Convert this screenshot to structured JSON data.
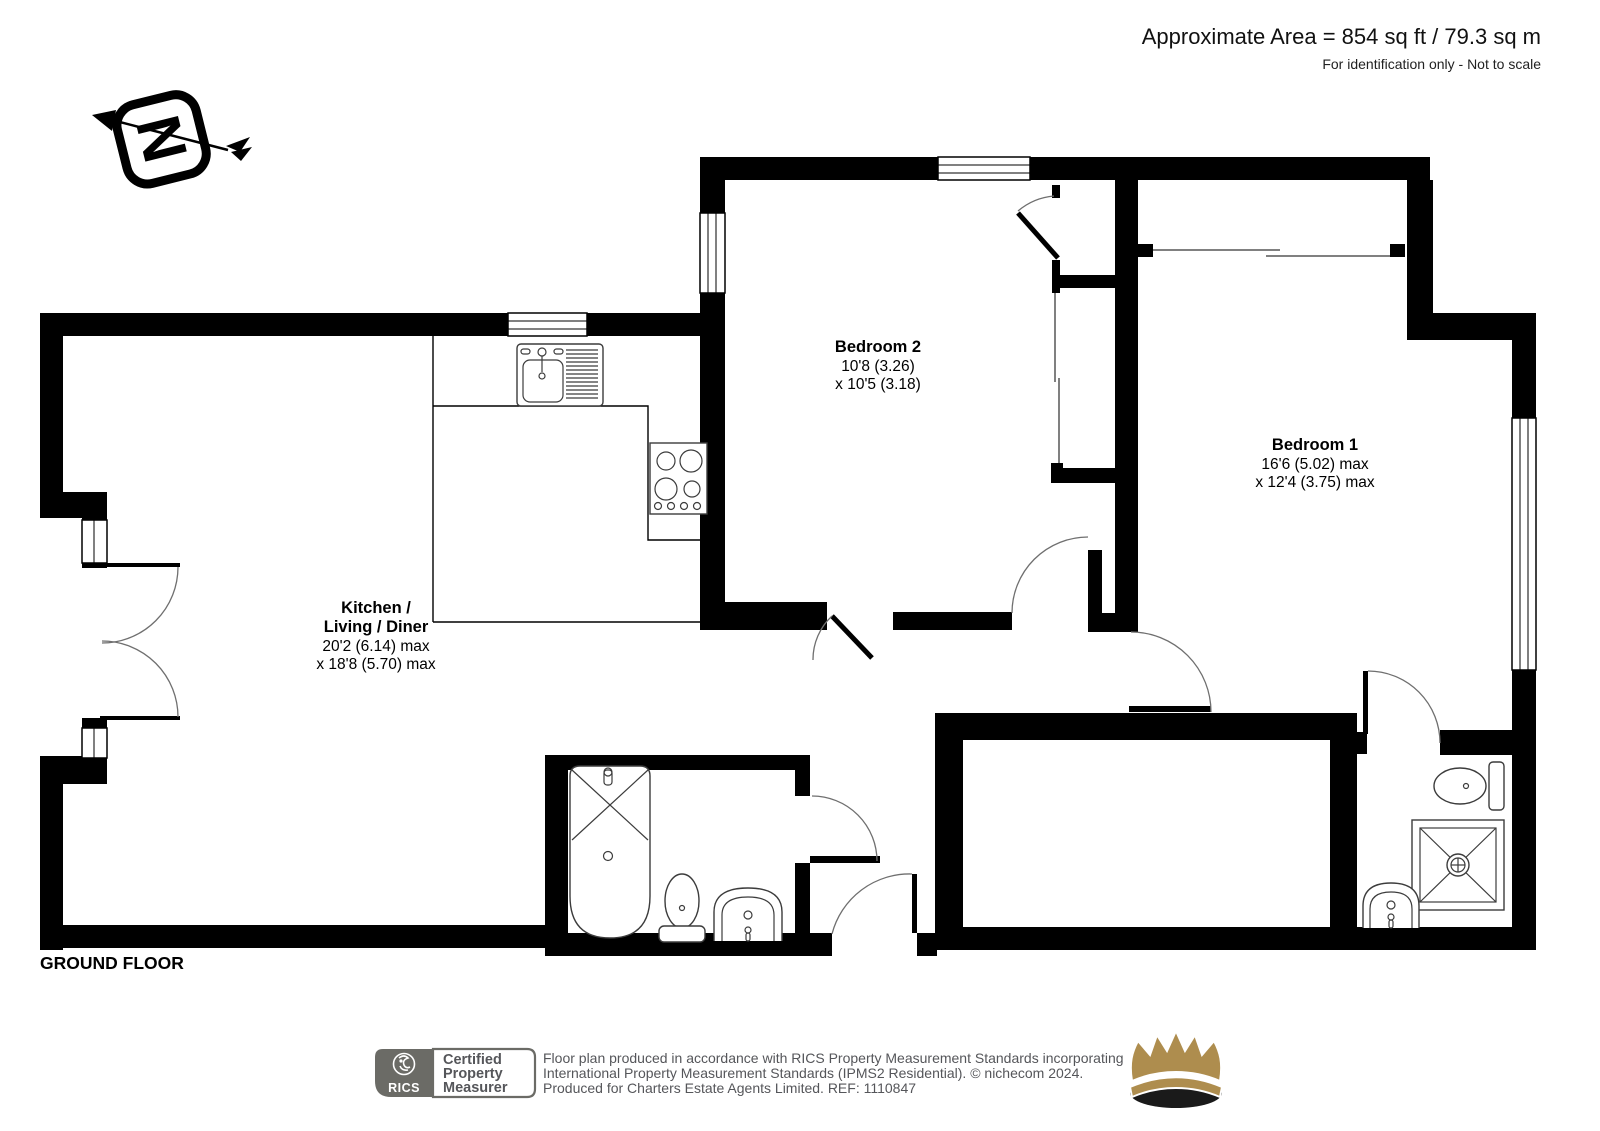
{
  "header": {
    "area": "Approximate Area = 854 sq ft / 79.3 sq m",
    "note": "For identification only - Not to scale"
  },
  "compass": {
    "letter": "N"
  },
  "plan": {
    "floor_label": "GROUND FLOOR",
    "rooms": {
      "kitchen_living_diner": {
        "name_line1": "Kitchen /",
        "name_line2": "Living / Diner",
        "dims_line1": "20'2 (6.14) max",
        "dims_line2": "x 18'8 (5.70) max"
      },
      "bedroom_2": {
        "name": "Bedroom 2",
        "dims_line1": "10'8 (3.26)",
        "dims_line2": "x 10'5 (3.18)"
      },
      "bedroom_1": {
        "name": "Bedroom 1",
        "dims_line1": "16'6 (5.02) max",
        "dims_line2": "x 12'4 (3.75) max"
      }
    }
  },
  "footer": {
    "rics_wordmark": "RICS",
    "certified_line1": "Certified",
    "certified_line2": "Property",
    "certified_line3": "Measurer",
    "disclaimer_line1": "Floor plan produced in accordance with RICS Property Measurement Standards incorporating",
    "disclaimer_line2": "International Property Measurement Standards (IPMS2 Residential).   © nichecom 2024.",
    "disclaimer_line3": "Produced for Charters Estate Agents Limited.   REF:  1110847"
  },
  "colors": {
    "wall": "#000000",
    "crown_gold": "#AE8D4E",
    "logo_gray": "#6B6B66",
    "muted_text": "#55565A"
  }
}
